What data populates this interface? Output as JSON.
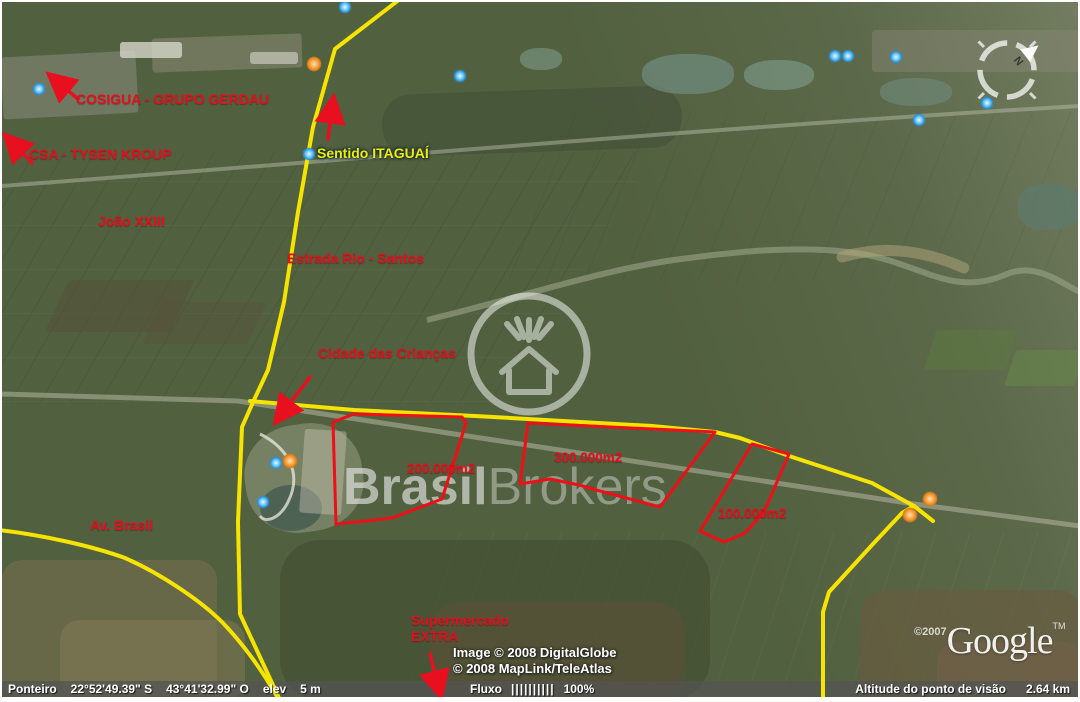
{
  "map_labels": {
    "cosigua": "COSIGUA - GRUPO GERDAU",
    "csa": "CSA - TYSEN KROUP",
    "joao_xxiii": "João XXIII",
    "estrada": "Estrada Rio - Santos",
    "sentido": "Sentido ITAGUAÍ",
    "cidade": "Cidade das Crianças",
    "av_brasil": "Av. Brasil",
    "supermercado_l1": "Supermercado",
    "supermercado_l2": "EXTRA",
    "area_200": "200.000m2",
    "area_300": "300.000m2",
    "area_100": "100.000m2"
  },
  "watermark": {
    "bold": "Brasil",
    "light": "Brokers"
  },
  "attribution": {
    "line1": "Image © 2008 DigitalGlobe",
    "line2": "© 2008 MapLink/TeleAtlas"
  },
  "google": {
    "copyright": "©2007",
    "name": "Google",
    "tm": "TM"
  },
  "compass": {
    "north": "N"
  },
  "status_bar": {
    "pointer_label": "Ponteiro",
    "latitude": "22°52'49.39\" S",
    "longitude": "43°41'32.99\" O",
    "elev_label": "elev",
    "elev_value": "5 m",
    "stream_label": "Fluxo",
    "stream_bars": "||||||||||",
    "stream_pct": "100%",
    "altitude_label": "Altitude do ponto de visão",
    "altitude_value": "2.64 km"
  },
  "colors": {
    "annotation_red": "#e8101e",
    "route_yellow": "#f6e400",
    "placemark_blue": "#58bdf2",
    "placemark_orange": "#f09b3c"
  }
}
